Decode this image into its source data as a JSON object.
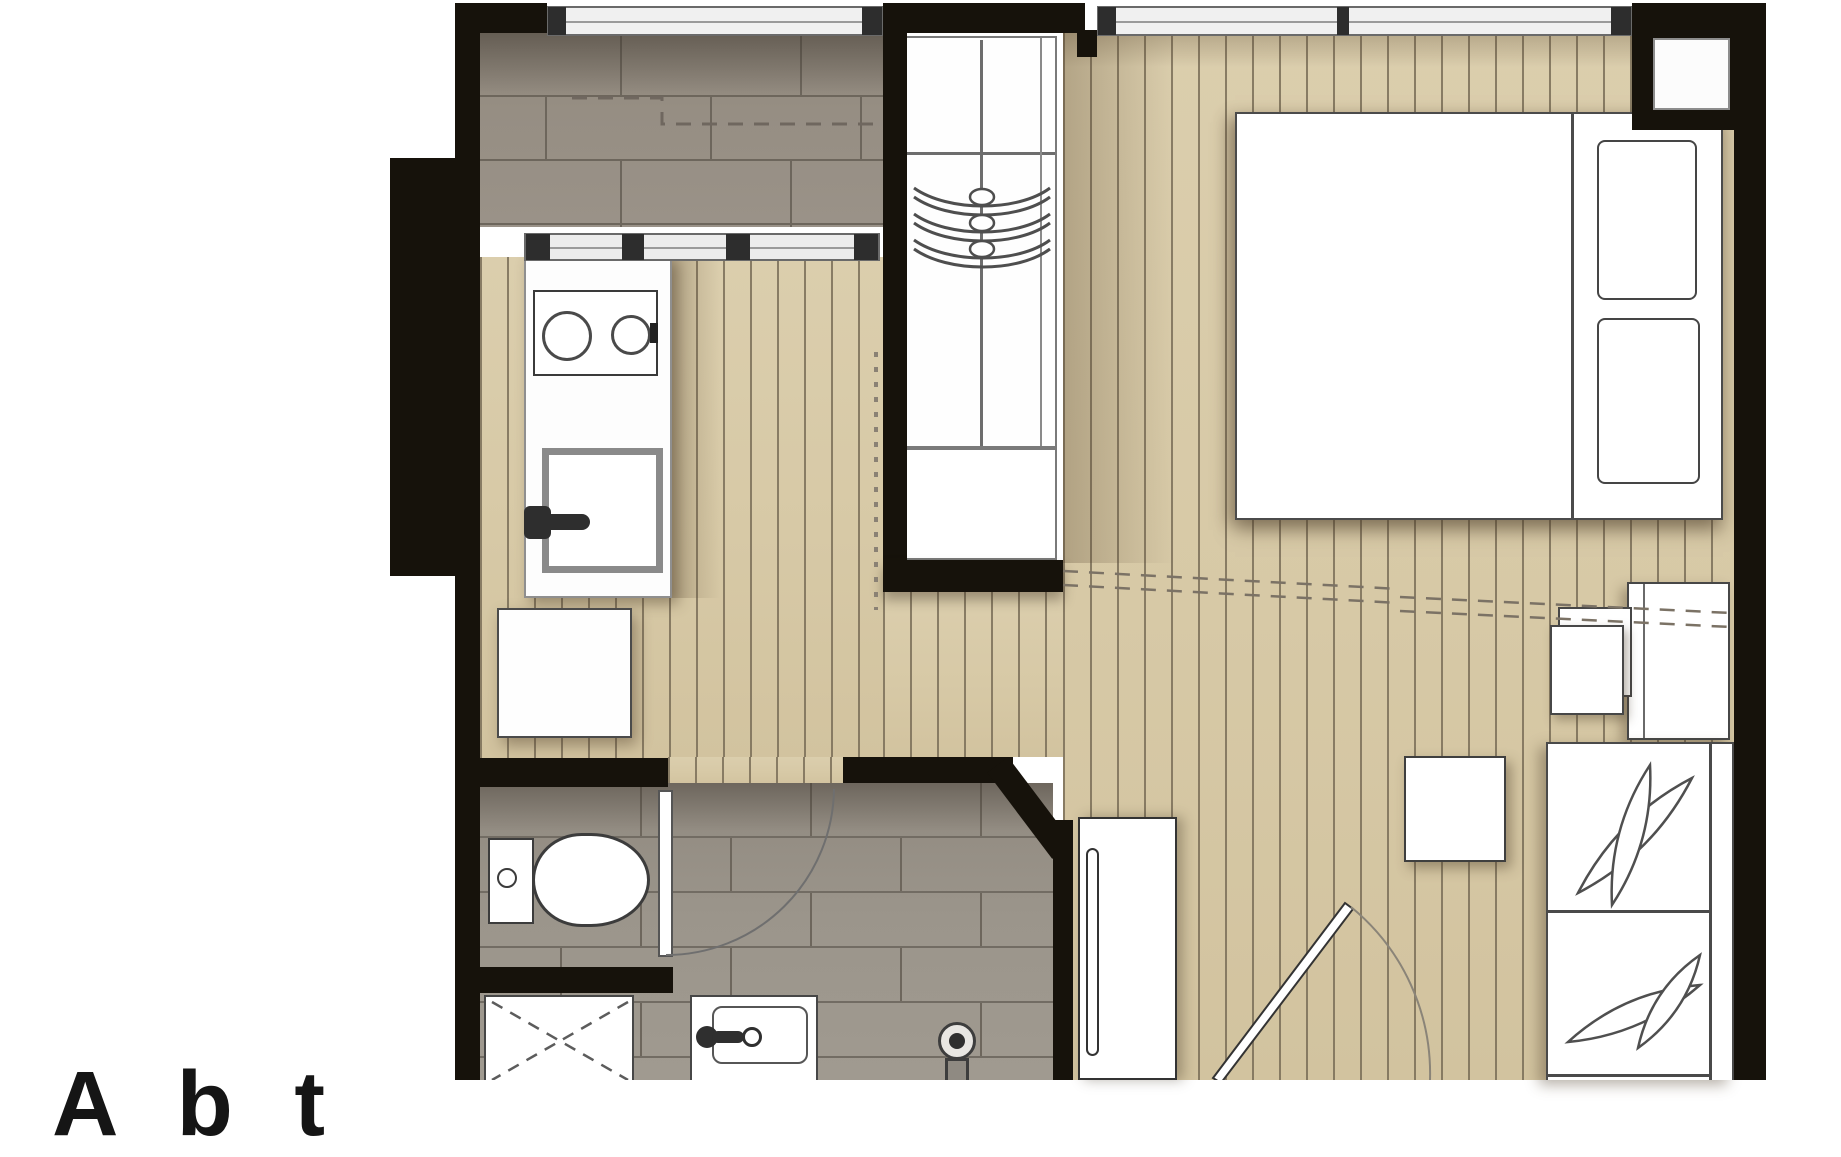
{
  "document": {
    "type": "apartment-floor-plan",
    "cutoff_text": "A b t"
  },
  "palette": {
    "wall_black": "#16120b",
    "wood_floor": "#d7c9a6",
    "wood_stripe": "#7a6e58",
    "kitchen_tile": "#968e83",
    "bath_tile": "#9b958b",
    "furniture_white": "#fefefe",
    "outline_gray": "#4b4b4b",
    "window_band": "#f0f0f0"
  },
  "rooms": {
    "kitchen": [
      "stove-2-burners",
      "counter",
      "sink",
      "fridge-cabinet",
      "sliding-glass-partition"
    ],
    "wardrobe": [
      "hanger-rail",
      "3-hangers",
      "lower-drawer-cabinet"
    ],
    "bedroom": [
      "double-bed",
      "2-pillows",
      "corner-niche",
      "desk",
      "stool",
      "window-band"
    ],
    "living": [
      "coffee-table",
      "bench-sofa-2-leaf-cushions",
      "entry-door",
      "tall-entry-cabinet"
    ],
    "bathroom": [
      "door-with-swing",
      "toilet",
      "washer-cabinet",
      "shower-tray",
      "vanity-sink",
      "floor-mixer"
    ]
  }
}
